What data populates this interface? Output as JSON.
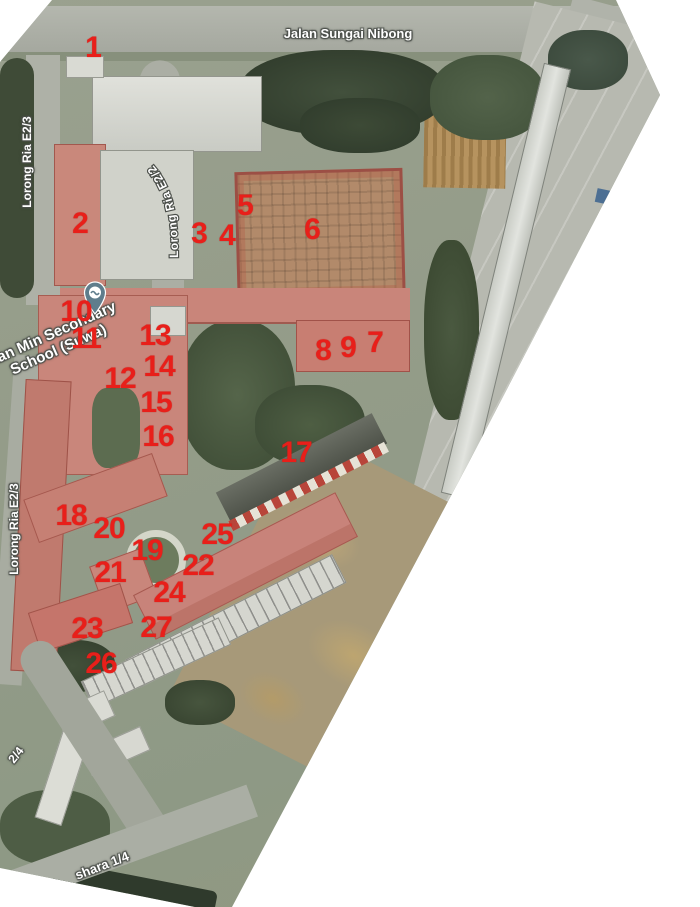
{
  "map": {
    "type": "satellite",
    "aria_label": "Satellite map of school campus with numbered building markers",
    "marker_color": "#e81f1a",
    "markers": [
      {
        "n": "1",
        "x": 93,
        "y": 48
      },
      {
        "n": "2",
        "x": 80,
        "y": 224
      },
      {
        "n": "3",
        "x": 199,
        "y": 234
      },
      {
        "n": "4",
        "x": 227,
        "y": 236
      },
      {
        "n": "5",
        "x": 245,
        "y": 206
      },
      {
        "n": "6",
        "x": 312,
        "y": 230
      },
      {
        "n": "7",
        "x": 375,
        "y": 343
      },
      {
        "n": "8",
        "x": 323,
        "y": 351
      },
      {
        "n": "9",
        "x": 348,
        "y": 348
      },
      {
        "n": "10",
        "x": 76,
        "y": 312
      },
      {
        "n": "11",
        "x": 86,
        "y": 339
      },
      {
        "n": "12",
        "x": 120,
        "y": 379
      },
      {
        "n": "13",
        "x": 155,
        "y": 336
      },
      {
        "n": "14",
        "x": 159,
        "y": 367
      },
      {
        "n": "15",
        "x": 156,
        "y": 403
      },
      {
        "n": "16",
        "x": 158,
        "y": 437
      },
      {
        "n": "17",
        "x": 296,
        "y": 453
      },
      {
        "n": "18",
        "x": 71,
        "y": 516
      },
      {
        "n": "19",
        "x": 147,
        "y": 551
      },
      {
        "n": "20",
        "x": 109,
        "y": 529
      },
      {
        "n": "21",
        "x": 110,
        "y": 573
      },
      {
        "n": "22",
        "x": 198,
        "y": 566
      },
      {
        "n": "23",
        "x": 87,
        "y": 629
      },
      {
        "n": "24",
        "x": 169,
        "y": 593
      },
      {
        "n": "25",
        "x": 217,
        "y": 535
      },
      {
        "n": "26",
        "x": 101,
        "y": 664
      },
      {
        "n": "27",
        "x": 156,
        "y": 628
      }
    ],
    "street_labels": {
      "top_road": "Jalan Sungai Nibong",
      "left_upper_road": "Lorong Ria E2/3",
      "curved_road": "Lorong Ria E2/2",
      "left_lower_road": "Lorong Ria E2/3",
      "bottom_left_fragment": "2/4",
      "bottom_fragment": "shara 1/4"
    },
    "place_label": {
      "line1": "Han Min Secondary",
      "line2": "School (Suwa)"
    }
  }
}
